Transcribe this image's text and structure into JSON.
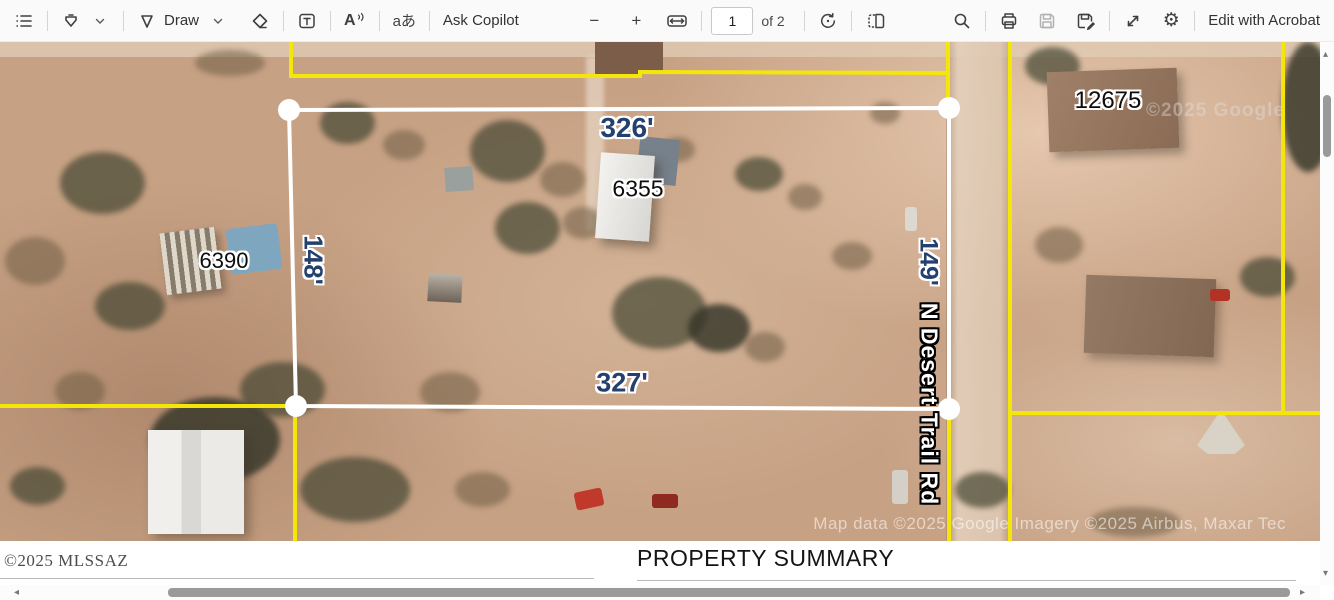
{
  "toolbar": {
    "draw_label": "Draw",
    "ask_copilot": "Ask Copilot",
    "page_number": "1",
    "page_count": "of 2",
    "edit_with_acrobat": "Edit with Acrobat",
    "icons": {
      "read_aloud": "A",
      "translate": "aあ",
      "zoom_out": "−",
      "zoom_in": "+",
      "settings_gear": "⚙"
    }
  },
  "map": {
    "measurements": {
      "top": "326'",
      "left": "148'",
      "bottom": "327'",
      "right": "149'"
    },
    "addresses": {
      "subject": "6355",
      "west_neighbor": "6390",
      "east_neighbor": "12675"
    },
    "road_name": "N Desert Trail Rd",
    "google_watermark": "©2025 Google",
    "attribution": "Map data ©2025 Google  Imagery ©2025 Airbus, Maxar Tec",
    "colors": {
      "parcel_line_yellow": "#f5e60a",
      "subject_outline_white": "#ffffff",
      "dimension_text_navy": "#24406e"
    }
  },
  "footer": {
    "copyright": "©2025 MLSSAZ",
    "section_title": "PROPERTY SUMMARY"
  },
  "scroll": {
    "up": "▴",
    "down": "▾",
    "left": "◂",
    "right": "▸"
  }
}
